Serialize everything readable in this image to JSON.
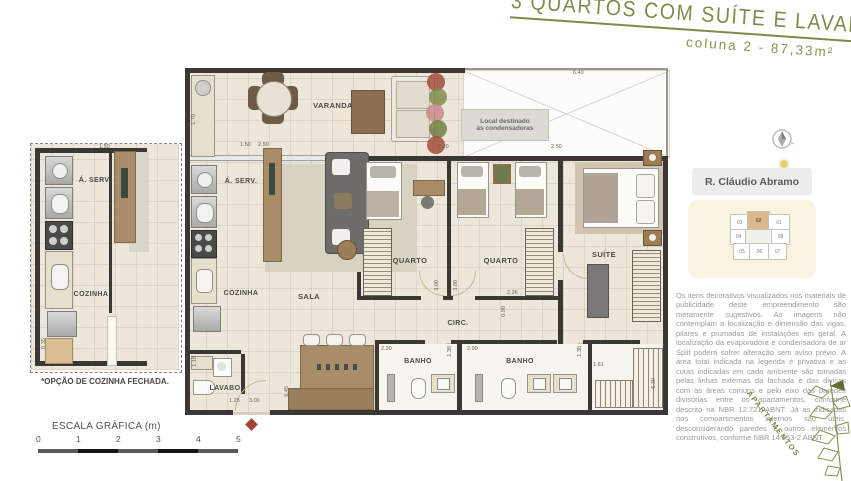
{
  "header": {
    "title": "3 QUARTOS COM SUÍTE E LAVABO",
    "subtitle": "coluna 2 - 87,33m²"
  },
  "plan": {
    "rooms": {
      "varanda": "VARANDA",
      "aserv": "Á. SERV.",
      "cozinha": "COZINHA",
      "sala": "SALA",
      "quarto1": "QUARTO",
      "quarto2": "QUARTO",
      "suite": "SUÍTE",
      "circ": "CIRC.",
      "lavabo": "LAVABO",
      "banho1": "BANHO",
      "banho2": "BANHO"
    },
    "condenser_line1": "Local destinado",
    "condenser_line2": "às condensadoras",
    "dims": [
      "6.40",
      "1.70",
      "1.50",
      "2.50",
      "2.20",
      "2.50",
      "3.00",
      "3.00",
      "2.26",
      "0.90",
      "2.20",
      "1.38",
      "2.90",
      "1.38",
      "1.61",
      "6.30",
      "1.18",
      "1.25",
      "3.00",
      "6.45"
    ]
  },
  "small_plan": {
    "aserv": "Á. SERV.",
    "cozinha": "COZINHA",
    "caption": "*OPÇÃO DE COZINHA FECHADA.",
    "dims": [
      "1.50",
      "0.35"
    ]
  },
  "sidebar": {
    "street": "R. Cláudio Abramo",
    "units": [
      "03",
      "02",
      "01",
      "04",
      "08",
      "05",
      "06",
      "07"
    ],
    "highlighted_unit": "02",
    "disclaimer": "Os itens decorativos visualizados nos materiais de publicidade deste empreendimento são meramente sugestivos. As imagens não contemplam a localização e dimensão das vigas, pilares e prumadas de instalações em geral. A localização da evaporadora e condensadora de ar Split poderá sofrer alteração sem aviso prévio. A área total indicada na legenda é privativa e as cotas indicadas em cada ambiente são tomadas pelas linhas externas da fachada e das divisas com as áreas comuns e pelo eixo das paredes divisórias entre os apartamentos, conforme descrito na NBR 12.721 ABNT. Já as indicadas nos compartimentos internos são úteis, desconsiderando paredes e outros elementos construtivos, conforme NBR 14.653-2 ABNT."
  },
  "branding": {
    "vertical_label": "APARTAMENTOS"
  },
  "scale": {
    "label": "ESCALA GRÁFICA (m)",
    "ticks": [
      "0",
      "1",
      "2",
      "3",
      "4",
      "5"
    ]
  },
  "colors": {
    "accent_olive": "#7E8C4B",
    "wall": "#3A3734",
    "floor": "#EDE7DB",
    "unit_highlight": "#D9B88C",
    "entry_marker": "#A3402F"
  }
}
